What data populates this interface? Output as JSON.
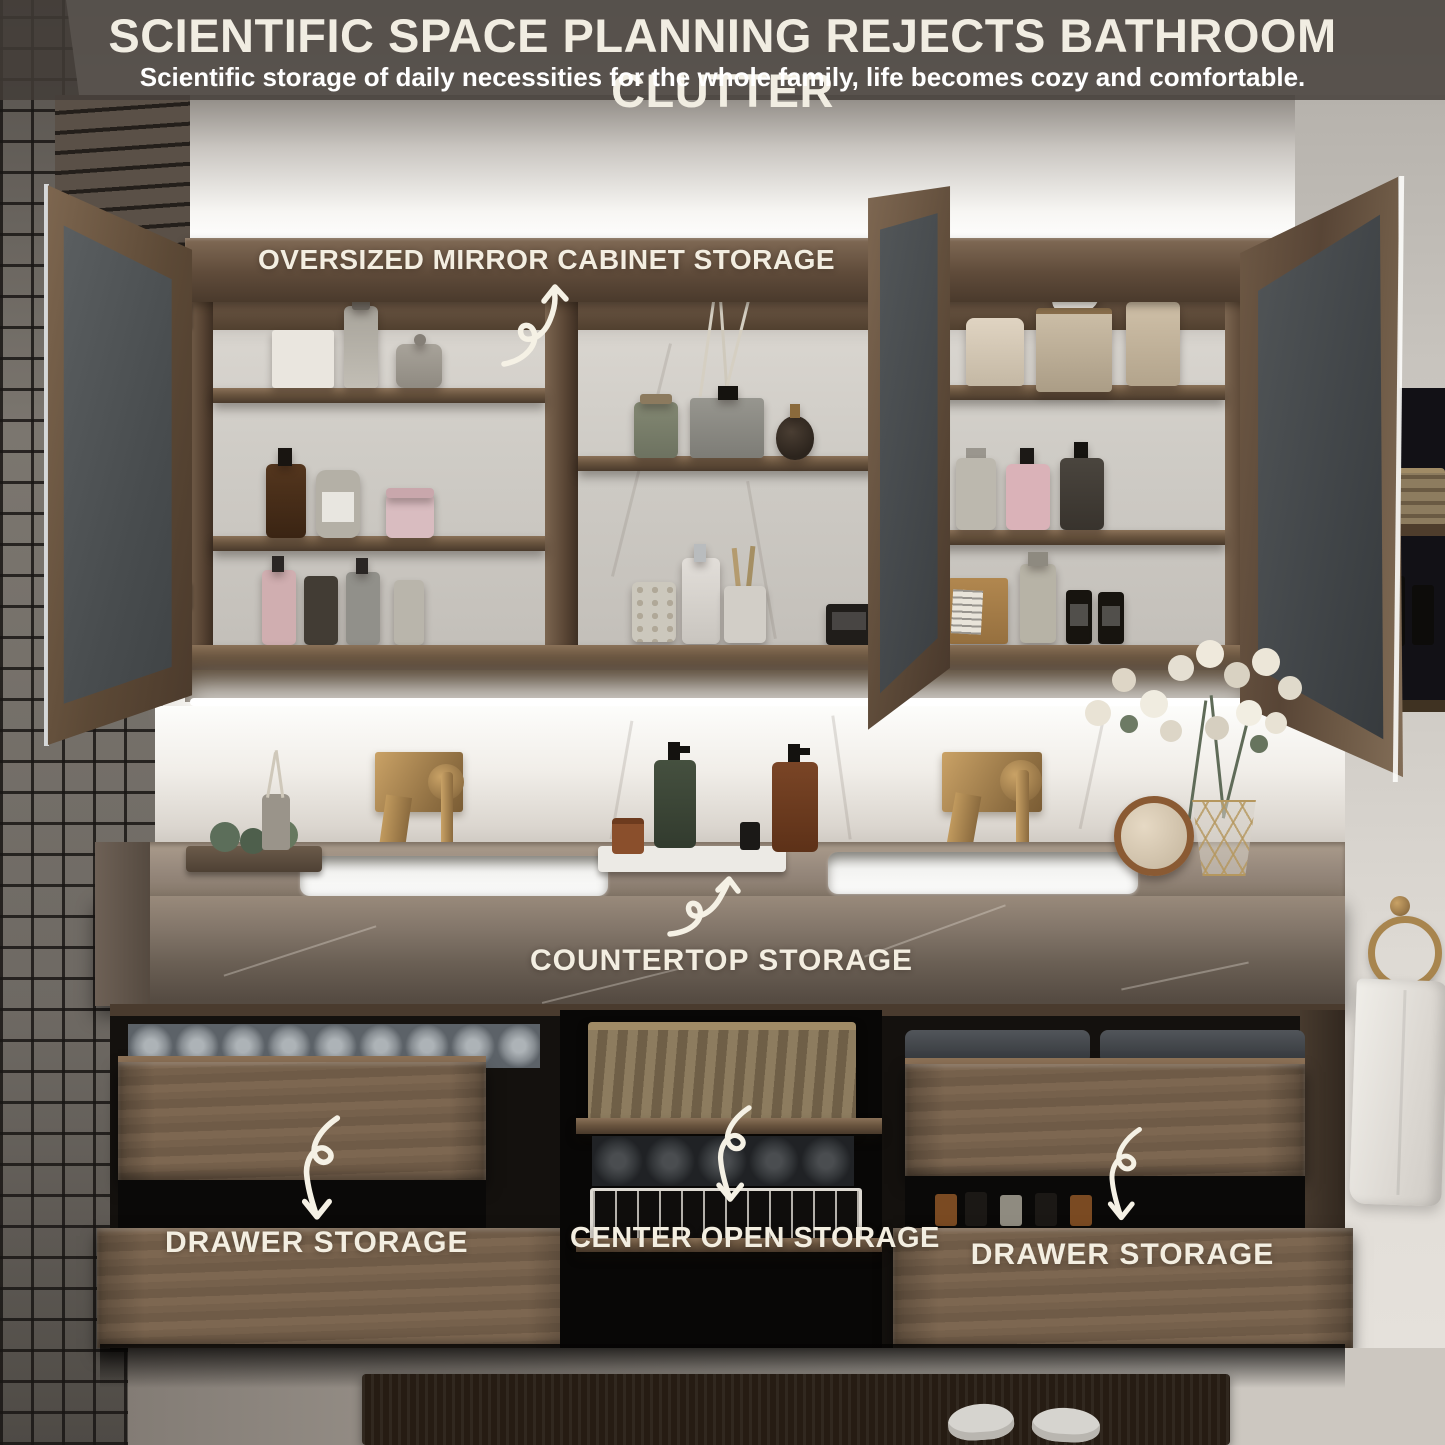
{
  "header": {
    "title": "SCIENTIFIC SPACE PLANNING REJECTS BATHROOM CLUTTER",
    "subtitle": "Scientific storage of daily necessities for the whole family, life becomes cozy and comfortable."
  },
  "callouts": {
    "mirror_cabinet": "OVERSIZED MIRROR CABINET STORAGE",
    "countertop": "COUNTERTOP STORAGE",
    "drawer_left": "DRAWER STORAGE",
    "center_open": "CENTER OPEN STORAGE",
    "drawer_right": "DRAWER STORAGE"
  },
  "icons": {
    "callout_arrow": "hand-drawn-curly-arrow"
  },
  "colors": {
    "header_overlay": "rgba(66,60,55,0.83)",
    "label_cream": "#f3eee1",
    "arrow_white": "#f5f1e5",
    "cabinet_wood": "#6a553f",
    "drawer_wood": "#76614c",
    "counter_marble": "#6b6055",
    "brass_gold": "#b28b55",
    "backsplash_white": "#f1eee9",
    "mosaic_gray": "#6f6a64"
  }
}
